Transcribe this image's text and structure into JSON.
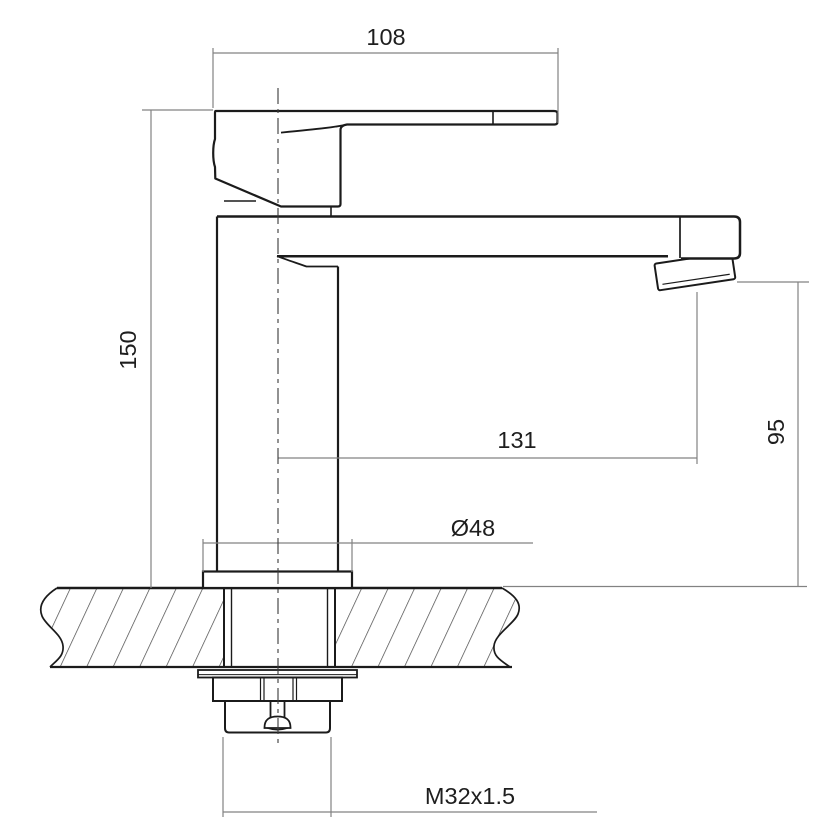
{
  "drawing": {
    "dimensions": {
      "lever_width": "108",
      "body_height": "150",
      "spout_reach": "131",
      "spout_height": "95",
      "base_diameter": "Ø48",
      "thread_size": "M32x1.5"
    }
  }
}
